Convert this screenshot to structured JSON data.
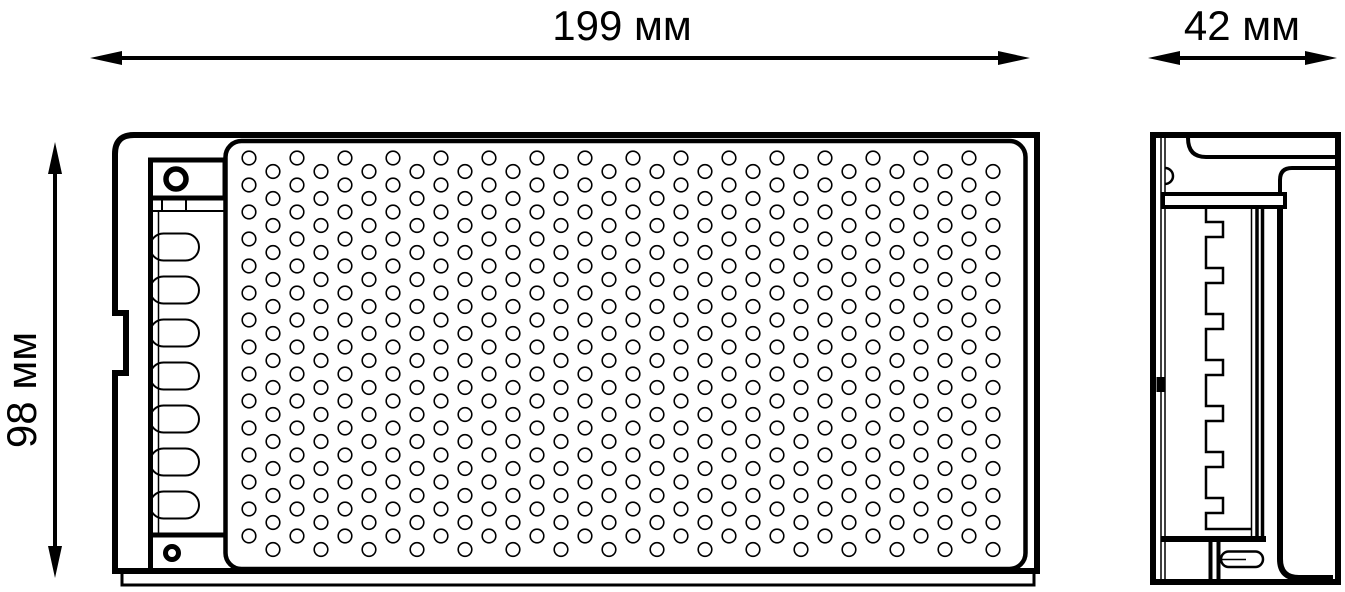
{
  "title": "LED driver dimensional drawing",
  "colors": {
    "line": "#000000",
    "background": "#ffffff"
  },
  "dimensions": {
    "width_label": "199 мм",
    "height_label": "98 мм",
    "depth_label": "42 мм"
  },
  "drawing": {
    "perforation": {
      "cols": 32,
      "rows": 15,
      "x0": 249,
      "y0": 158,
      "col_pitch": 24,
      "row_pitch": 27,
      "stagger": 13.5,
      "hole_radius": 6.8,
      "stroke": 1.6
    },
    "terminal_slots": {
      "count": 7,
      "x": 150,
      "width": 49,
      "height": 27,
      "first_center_y": 247,
      "pitch": 43,
      "corner_radius": 13.5,
      "stroke": 2
    }
  }
}
